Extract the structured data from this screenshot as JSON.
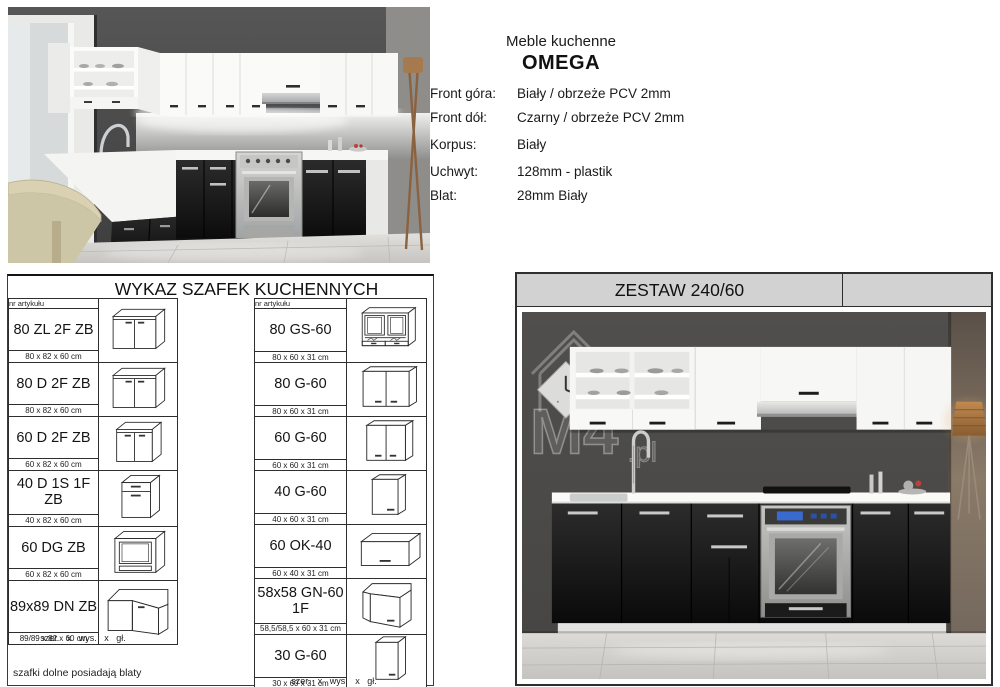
{
  "specs": {
    "title": "Meble kuchenne",
    "product_name": "OMEGA",
    "rows": [
      {
        "label": "Front góra:",
        "value": "Biały / obrzeże PCV 2mm"
      },
      {
        "label": "Front dół:",
        "value": "Czarny / obrzeże PCV 2mm"
      },
      {
        "label": "Korpus:",
        "value": "Biały"
      },
      {
        "label": "Uchwyt:",
        "value": "128mm - plastik"
      },
      {
        "label": "Blat:",
        "value": "28mm Biały"
      }
    ]
  },
  "wykaz": {
    "title": "WYKAZ SZAFEK KUCHENNYCH",
    "column_header": "nr artykułu",
    "footer": "szer. x wys. x gł.",
    "note": "szafki dolne posiadają blaty",
    "groups": [
      {
        "items": [
          {
            "code": "80 ZL 2F ZB",
            "dims": "80 x 82 x 60 cm",
            "drawing": "base-2door"
          },
          {
            "code": "80 D 2F ZB",
            "dims": "80 x 82 x 60 cm",
            "drawing": "base-2door"
          },
          {
            "code": "60 D 2F ZB",
            "dims": "60 x 82 x 60 cm",
            "drawing": "base-2door-narrow"
          },
          {
            "code": "40 D 1S 1F ZB",
            "dims": "40 x 82 x 60 cm",
            "drawing": "base-drawer-door"
          },
          {
            "code": "60 DG ZB",
            "dims": "60 x 82 x 60 cm",
            "drawing": "base-oven"
          },
          {
            "code": "89x89 DN ZB",
            "dims": "89/89 x 82 x 60 cm",
            "drawing": "base-corner"
          }
        ]
      },
      {
        "items": [
          {
            "code": "80 GS-60",
            "dims": "80 x 60 x 31 cm",
            "drawing": "wall-glass"
          },
          {
            "code": "80 G-60",
            "dims": "80 x 60 x 31 cm",
            "drawing": "wall-2door"
          },
          {
            "code": "60 G-60",
            "dims": "60 x 60 x 31 cm",
            "drawing": "wall-2door-narrow"
          },
          {
            "code": "40 G-60",
            "dims": "40 x 60 x 31 cm",
            "drawing": "wall-1door"
          },
          {
            "code": "60 OK-40",
            "dims": "60 x 40 x 31 cm",
            "drawing": "wall-flip"
          },
          {
            "code": "58x58 GN-60 1F",
            "dims": "58,5/58,5 x 60 x 31 cm",
            "drawing": "wall-corner"
          },
          {
            "code": "30 G-60",
            "dims": "30 x 60 x 31 cm",
            "drawing": "wall-1door-narrow"
          }
        ]
      }
    ]
  },
  "zestaw": {
    "title": "ZESTAW 240/60",
    "watermark": {
      "text": "M4",
      "suffix": ".pl"
    }
  },
  "colors": {
    "zestaw_header_bg": "#d2d2d2",
    "front_top": "#ffffff",
    "front_bottom": "#161616",
    "wall_dark": "#4c4b49",
    "floor": "#d6d4d0"
  }
}
